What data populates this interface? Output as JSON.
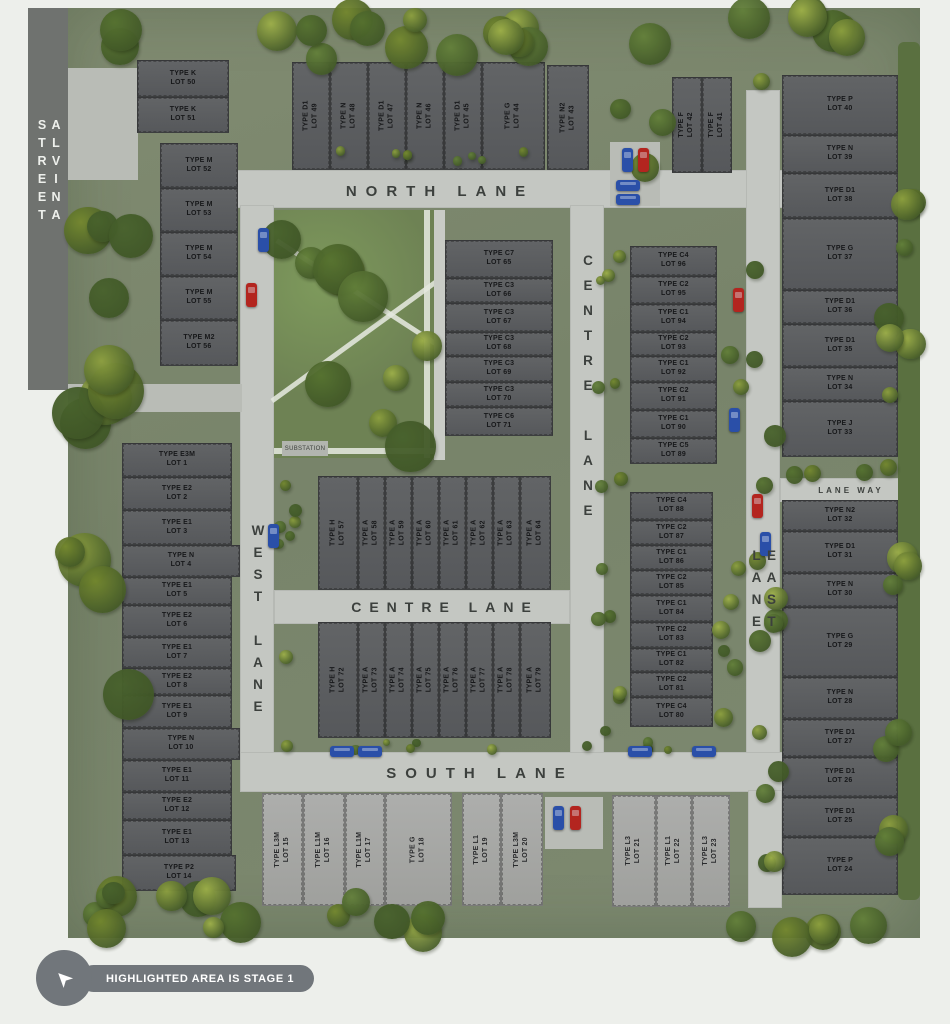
{
  "legend": {
    "label": "HIGHLIGHTED AREA IS STAGE 1"
  },
  "park": {
    "substation_label": "SUBSTATION"
  },
  "streets": [
    {
      "id": "alvina-street",
      "label": "ALVINA STREET",
      "orientation": "vertical"
    },
    {
      "id": "north-lane",
      "label": "NORTH LANE",
      "orientation": "horizontal"
    },
    {
      "id": "centre-lane-vertical",
      "label": "CENTRE LANE",
      "orientation": "vertical"
    },
    {
      "id": "centre-lane-horizontal",
      "label": "CENTRE LANE",
      "orientation": "horizontal"
    },
    {
      "id": "west-lane",
      "label": "WEST LANE",
      "orientation": "vertical"
    },
    {
      "id": "east-lane",
      "label": "EAST LANE",
      "orientation": "vertical"
    },
    {
      "id": "south-lane",
      "label": "SOUTH LANE",
      "orientation": "horizontal"
    },
    {
      "id": "lane-way",
      "label": "LANE WAY",
      "orientation": "horizontal"
    }
  ],
  "lots": [
    {
      "type": "TYPE E3M",
      "lot": "LOT 1",
      "x": 122,
      "y": 443,
      "w": 110,
      "h": 34
    },
    {
      "type": "TYPE E2",
      "lot": "LOT 2",
      "x": 122,
      "y": 477,
      "w": 110,
      "h": 33
    },
    {
      "type": "TYPE E1",
      "lot": "LOT 3",
      "x": 122,
      "y": 510,
      "w": 110,
      "h": 35
    },
    {
      "type": "TYPE N",
      "lot": "LOT 4",
      "x": 122,
      "y": 545,
      "w": 118,
      "h": 32
    },
    {
      "type": "TYPE E1",
      "lot": "LOT 5",
      "x": 122,
      "y": 577,
      "w": 110,
      "h": 28
    },
    {
      "type": "TYPE E2",
      "lot": "LOT 6",
      "x": 122,
      "y": 605,
      "w": 110,
      "h": 32
    },
    {
      "type": "TYPE E1",
      "lot": "LOT 7",
      "x": 122,
      "y": 637,
      "w": 110,
      "h": 31
    },
    {
      "type": "TYPE E2",
      "lot": "LOT 8",
      "x": 122,
      "y": 668,
      "w": 110,
      "h": 27
    },
    {
      "type": "TYPE E1",
      "lot": "LOT 9",
      "x": 122,
      "y": 695,
      "w": 110,
      "h": 33
    },
    {
      "type": "TYPE N",
      "lot": "LOT 10",
      "x": 122,
      "y": 728,
      "w": 118,
      "h": 32
    },
    {
      "type": "TYPE E1",
      "lot": "LOT 11",
      "x": 122,
      "y": 760,
      "w": 110,
      "h": 32
    },
    {
      "type": "TYPE E2",
      "lot": "LOT 12",
      "x": 122,
      "y": 792,
      "w": 110,
      "h": 28
    },
    {
      "type": "TYPE E1",
      "lot": "LOT 13",
      "x": 122,
      "y": 820,
      "w": 110,
      "h": 35
    },
    {
      "type": "TYPE P2",
      "lot": "LOT 14",
      "x": 122,
      "y": 855,
      "w": 114,
      "h": 36
    },
    {
      "type": "TYPE L3M",
      "lot": "LOT 15",
      "x": 262,
      "y": 793,
      "w": 41,
      "h": 113,
      "o": "v",
      "s": "l"
    },
    {
      "type": "TYPE L1M",
      "lot": "LOT 16",
      "x": 303,
      "y": 793,
      "w": 42,
      "h": 113,
      "o": "v",
      "s": "l"
    },
    {
      "type": "TYPE L1M",
      "lot": "LOT 17",
      "x": 345,
      "y": 793,
      "w": 40,
      "h": 113,
      "o": "v",
      "s": "l"
    },
    {
      "type": "TYPE G",
      "lot": "LOT 18",
      "x": 385,
      "y": 793,
      "w": 67,
      "h": 113,
      "o": "v",
      "s": "l"
    },
    {
      "type": "TYPE L1",
      "lot": "LOT 19",
      "x": 462,
      "y": 793,
      "w": 39,
      "h": 113,
      "o": "v",
      "s": "l"
    },
    {
      "type": "TYPE L3M",
      "lot": "LOT 20",
      "x": 501,
      "y": 793,
      "w": 42,
      "h": 113,
      "o": "v",
      "s": "l"
    },
    {
      "type": "TYPE L3",
      "lot": "LOT 21",
      "x": 612,
      "y": 795,
      "w": 44,
      "h": 112,
      "o": "v",
      "s": "l"
    },
    {
      "type": "TYPE L1",
      "lot": "LOT 22",
      "x": 656,
      "y": 795,
      "w": 36,
      "h": 112,
      "o": "v",
      "s": "l"
    },
    {
      "type": "TYPE L3",
      "lot": "LOT 23",
      "x": 692,
      "y": 795,
      "w": 38,
      "h": 112,
      "o": "v",
      "s": "l"
    },
    {
      "type": "TYPE P",
      "lot": "LOT 24",
      "x": 782,
      "y": 837,
      "w": 116,
      "h": 58
    },
    {
      "type": "TYPE D1",
      "lot": "LOT 25",
      "x": 782,
      "y": 797,
      "w": 116,
      "h": 40
    },
    {
      "type": "TYPE D1",
      "lot": "LOT 26",
      "x": 782,
      "y": 757,
      "w": 116,
      "h": 40
    },
    {
      "type": "TYPE D1",
      "lot": "LOT 27",
      "x": 782,
      "y": 719,
      "w": 116,
      "h": 38
    },
    {
      "type": "TYPE N",
      "lot": "LOT 28",
      "x": 782,
      "y": 677,
      "w": 116,
      "h": 42
    },
    {
      "type": "TYPE G",
      "lot": "LOT 29",
      "x": 782,
      "y": 607,
      "w": 116,
      "h": 70
    },
    {
      "type": "TYPE N",
      "lot": "LOT 30",
      "x": 782,
      "y": 573,
      "w": 116,
      "h": 34
    },
    {
      "type": "TYPE D1",
      "lot": "LOT 31",
      "x": 782,
      "y": 531,
      "w": 116,
      "h": 42
    },
    {
      "type": "TYPE N2",
      "lot": "LOT 32",
      "x": 782,
      "y": 500,
      "w": 116,
      "h": 31
    },
    {
      "type": "TYPE J",
      "lot": "LOT 33",
      "x": 782,
      "y": 401,
      "w": 116,
      "h": 56
    },
    {
      "type": "TYPE N",
      "lot": "LOT 34",
      "x": 782,
      "y": 367,
      "w": 116,
      "h": 34
    },
    {
      "type": "TYPE D1",
      "lot": "LOT 35",
      "x": 782,
      "y": 324,
      "w": 116,
      "h": 43
    },
    {
      "type": "TYPE D1",
      "lot": "LOT 36",
      "x": 782,
      "y": 290,
      "w": 116,
      "h": 34
    },
    {
      "type": "TYPE G",
      "lot": "LOT 37",
      "x": 782,
      "y": 218,
      "w": 116,
      "h": 72
    },
    {
      "type": "TYPE D1",
      "lot": "LOT 38",
      "x": 782,
      "y": 173,
      "w": 116,
      "h": 45
    },
    {
      "type": "TYPE N",
      "lot": "LOT 39",
      "x": 782,
      "y": 135,
      "w": 116,
      "h": 38
    },
    {
      "type": "TYPE P",
      "lot": "LOT 40",
      "x": 782,
      "y": 75,
      "w": 116,
      "h": 60
    },
    {
      "type": "TYPE F",
      "lot": "LOT 41",
      "x": 702,
      "y": 77,
      "w": 30,
      "h": 96,
      "o": "v"
    },
    {
      "type": "TYPE F",
      "lot": "LOT 42",
      "x": 672,
      "y": 77,
      "w": 30,
      "h": 96,
      "o": "v"
    },
    {
      "type": "TYPE N2",
      "lot": "LOT 43",
      "x": 547,
      "y": 65,
      "w": 42,
      "h": 105,
      "o": "v"
    },
    {
      "type": "TYPE G",
      "lot": "LOT 44",
      "x": 482,
      "y": 62,
      "w": 63,
      "h": 108,
      "o": "v"
    },
    {
      "type": "TYPE D1",
      "lot": "LOT 45",
      "x": 444,
      "y": 62,
      "w": 38,
      "h": 108,
      "o": "v"
    },
    {
      "type": "TYPE N",
      "lot": "LOT 46",
      "x": 406,
      "y": 62,
      "w": 38,
      "h": 108,
      "o": "v"
    },
    {
      "type": "TYPE D1",
      "lot": "LOT 47",
      "x": 368,
      "y": 62,
      "w": 38,
      "h": 108,
      "o": "v"
    },
    {
      "type": "TYPE N",
      "lot": "LOT 48",
      "x": 330,
      "y": 62,
      "w": 38,
      "h": 108,
      "o": "v"
    },
    {
      "type": "TYPE D1",
      "lot": "LOT 49",
      "x": 292,
      "y": 62,
      "w": 38,
      "h": 108,
      "o": "v"
    },
    {
      "type": "TYPE K",
      "lot": "LOT 50",
      "x": 137,
      "y": 60,
      "w": 92,
      "h": 37
    },
    {
      "type": "TYPE K",
      "lot": "LOT 51",
      "x": 137,
      "y": 97,
      "w": 92,
      "h": 36
    },
    {
      "type": "TYPE M",
      "lot": "LOT 52",
      "x": 160,
      "y": 143,
      "w": 78,
      "h": 45
    },
    {
      "type": "TYPE M",
      "lot": "LOT 53",
      "x": 160,
      "y": 188,
      "w": 78,
      "h": 44
    },
    {
      "type": "TYPE M",
      "lot": "LOT 54",
      "x": 160,
      "y": 232,
      "w": 78,
      "h": 44
    },
    {
      "type": "TYPE M",
      "lot": "LOT 55",
      "x": 160,
      "y": 276,
      "w": 78,
      "h": 44
    },
    {
      "type": "TYPE M2",
      "lot": "LOT 56",
      "x": 160,
      "y": 320,
      "w": 78,
      "h": 46
    },
    {
      "type": "TYPE H",
      "lot": "LOT 57",
      "x": 318,
      "y": 476,
      "w": 40,
      "h": 114,
      "o": "v"
    },
    {
      "type": "TYPE A",
      "lot": "LOT 58",
      "x": 358,
      "y": 476,
      "w": 27,
      "h": 114,
      "o": "v"
    },
    {
      "type": "TYPE A",
      "lot": "LOT 59",
      "x": 385,
      "y": 476,
      "w": 27,
      "h": 114,
      "o": "v"
    },
    {
      "type": "TYPE A",
      "lot": "LOT 60",
      "x": 412,
      "y": 476,
      "w": 27,
      "h": 114,
      "o": "v"
    },
    {
      "type": "TYPE A",
      "lot": "LOT 61",
      "x": 439,
      "y": 476,
      "w": 27,
      "h": 114,
      "o": "v"
    },
    {
      "type": "TYPE A",
      "lot": "LOT 62",
      "x": 466,
      "y": 476,
      "w": 27,
      "h": 114,
      "o": "v"
    },
    {
      "type": "TYPE A",
      "lot": "LOT 63",
      "x": 493,
      "y": 476,
      "w": 27,
      "h": 114,
      "o": "v"
    },
    {
      "type": "TYPE A",
      "lot": "LOT 64",
      "x": 520,
      "y": 476,
      "w": 31,
      "h": 114,
      "o": "v"
    },
    {
      "type": "TYPE C7",
      "lot": "LOT 65",
      "x": 445,
      "y": 240,
      "w": 108,
      "h": 38
    },
    {
      "type": "TYPE C3",
      "lot": "LOT 66",
      "x": 445,
      "y": 278,
      "w": 108,
      "h": 25
    },
    {
      "type": "TYPE C3",
      "lot": "LOT 67",
      "x": 445,
      "y": 303,
      "w": 108,
      "h": 29
    },
    {
      "type": "TYPE C3",
      "lot": "LOT 68",
      "x": 445,
      "y": 332,
      "w": 108,
      "h": 24
    },
    {
      "type": "TYPE C3",
      "lot": "LOT 69",
      "x": 445,
      "y": 356,
      "w": 108,
      "h": 26
    },
    {
      "type": "TYPE C3",
      "lot": "LOT 70",
      "x": 445,
      "y": 382,
      "w": 108,
      "h": 25
    },
    {
      "type": "TYPE C6",
      "lot": "LOT 71",
      "x": 445,
      "y": 407,
      "w": 108,
      "h": 29
    },
    {
      "type": "TYPE H",
      "lot": "LOT 72",
      "x": 318,
      "y": 622,
      "w": 40,
      "h": 116,
      "o": "v"
    },
    {
      "type": "TYPE A",
      "lot": "LOT 73",
      "x": 358,
      "y": 622,
      "w": 27,
      "h": 116,
      "o": "v"
    },
    {
      "type": "TYPE A",
      "lot": "LOT 74",
      "x": 385,
      "y": 622,
      "w": 27,
      "h": 116,
      "o": "v"
    },
    {
      "type": "TYPE A",
      "lot": "LOT 75",
      "x": 412,
      "y": 622,
      "w": 27,
      "h": 116,
      "o": "v"
    },
    {
      "type": "TYPE A",
      "lot": "LOT 76",
      "x": 439,
      "y": 622,
      "w": 27,
      "h": 116,
      "o": "v"
    },
    {
      "type": "TYPE A",
      "lot": "LOT 77",
      "x": 466,
      "y": 622,
      "w": 27,
      "h": 116,
      "o": "v"
    },
    {
      "type": "TYPE A",
      "lot": "LOT 78",
      "x": 493,
      "y": 622,
      "w": 27,
      "h": 116,
      "o": "v"
    },
    {
      "type": "TYPE A",
      "lot": "LOT 79",
      "x": 520,
      "y": 622,
      "w": 31,
      "h": 116,
      "o": "v"
    },
    {
      "type": "TYPE C4",
      "lot": "LOT 80",
      "x": 630,
      "y": 697,
      "w": 83,
      "h": 30
    },
    {
      "type": "TYPE C2",
      "lot": "LOT 81",
      "x": 630,
      "y": 672,
      "w": 83,
      "h": 25
    },
    {
      "type": "TYPE C1",
      "lot": "LOT 82",
      "x": 630,
      "y": 648,
      "w": 83,
      "h": 24
    },
    {
      "type": "TYPE C2",
      "lot": "LOT 83",
      "x": 630,
      "y": 622,
      "w": 83,
      "h": 26
    },
    {
      "type": "TYPE C1",
      "lot": "LOT 84",
      "x": 630,
      "y": 595,
      "w": 83,
      "h": 27
    },
    {
      "type": "TYPE C2",
      "lot": "LOT 85",
      "x": 630,
      "y": 570,
      "w": 83,
      "h": 25
    },
    {
      "type": "TYPE C1",
      "lot": "LOT 86",
      "x": 630,
      "y": 545,
      "w": 83,
      "h": 25
    },
    {
      "type": "TYPE C2",
      "lot": "LOT 87",
      "x": 630,
      "y": 520,
      "w": 83,
      "h": 25
    },
    {
      "type": "TYPE C4",
      "lot": "LOT 88",
      "x": 630,
      "y": 492,
      "w": 83,
      "h": 28
    },
    {
      "type": "TYPE C5",
      "lot": "LOT 89",
      "x": 630,
      "y": 438,
      "w": 87,
      "h": 26
    },
    {
      "type": "TYPE C1",
      "lot": "LOT 90",
      "x": 630,
      "y": 410,
      "w": 87,
      "h": 28
    },
    {
      "type": "TYPE C2",
      "lot": "LOT 91",
      "x": 630,
      "y": 382,
      "w": 87,
      "h": 28
    },
    {
      "type": "TYPE C1",
      "lot": "LOT 92",
      "x": 630,
      "y": 356,
      "w": 87,
      "h": 26
    },
    {
      "type": "TYPE C2",
      "lot": "LOT 93",
      "x": 630,
      "y": 332,
      "w": 87,
      "h": 24
    },
    {
      "type": "TYPE C1",
      "lot": "LOT 94",
      "x": 630,
      "y": 304,
      "w": 87,
      "h": 28
    },
    {
      "type": "TYPE C2",
      "lot": "LOT 95",
      "x": 630,
      "y": 276,
      "w": 87,
      "h": 28
    },
    {
      "type": "TYPE C4",
      "lot": "LOT 96",
      "x": 630,
      "y": 246,
      "w": 87,
      "h": 30
    }
  ]
}
